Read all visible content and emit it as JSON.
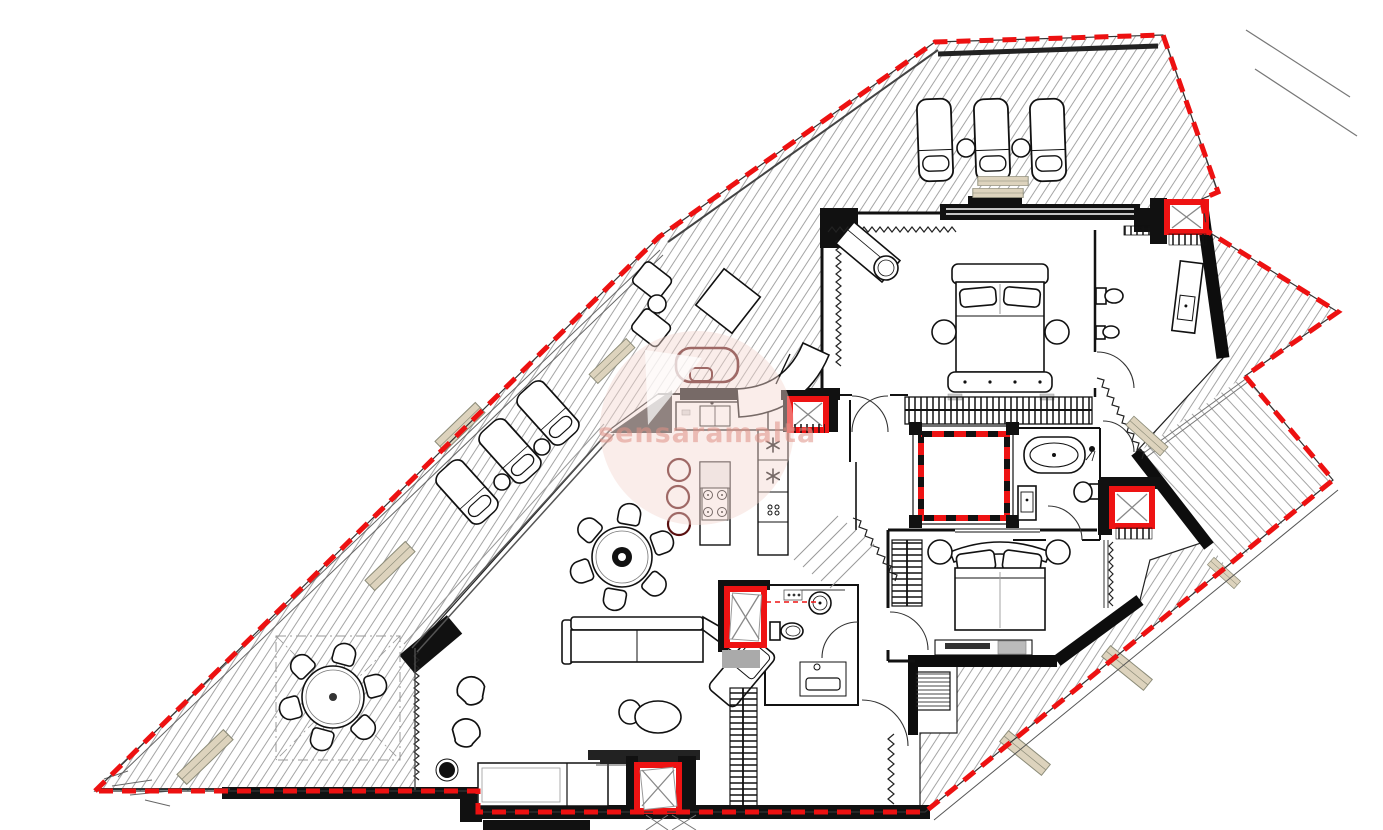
{
  "watermark": {
    "text": "sensaramalta"
  },
  "colors": {
    "boundary-red": "#ed1111",
    "shaft-red": "#ee1313",
    "wall-black": "#111111",
    "hatch-gray": "#9b9b9b",
    "planter-fill": "#ddd3bd",
    "planter-stroke": "#8b8b78",
    "watermark-pink": "#f4d6d0",
    "watermark-text": "#e09287",
    "accent-darkred": "#5a1010"
  }
}
